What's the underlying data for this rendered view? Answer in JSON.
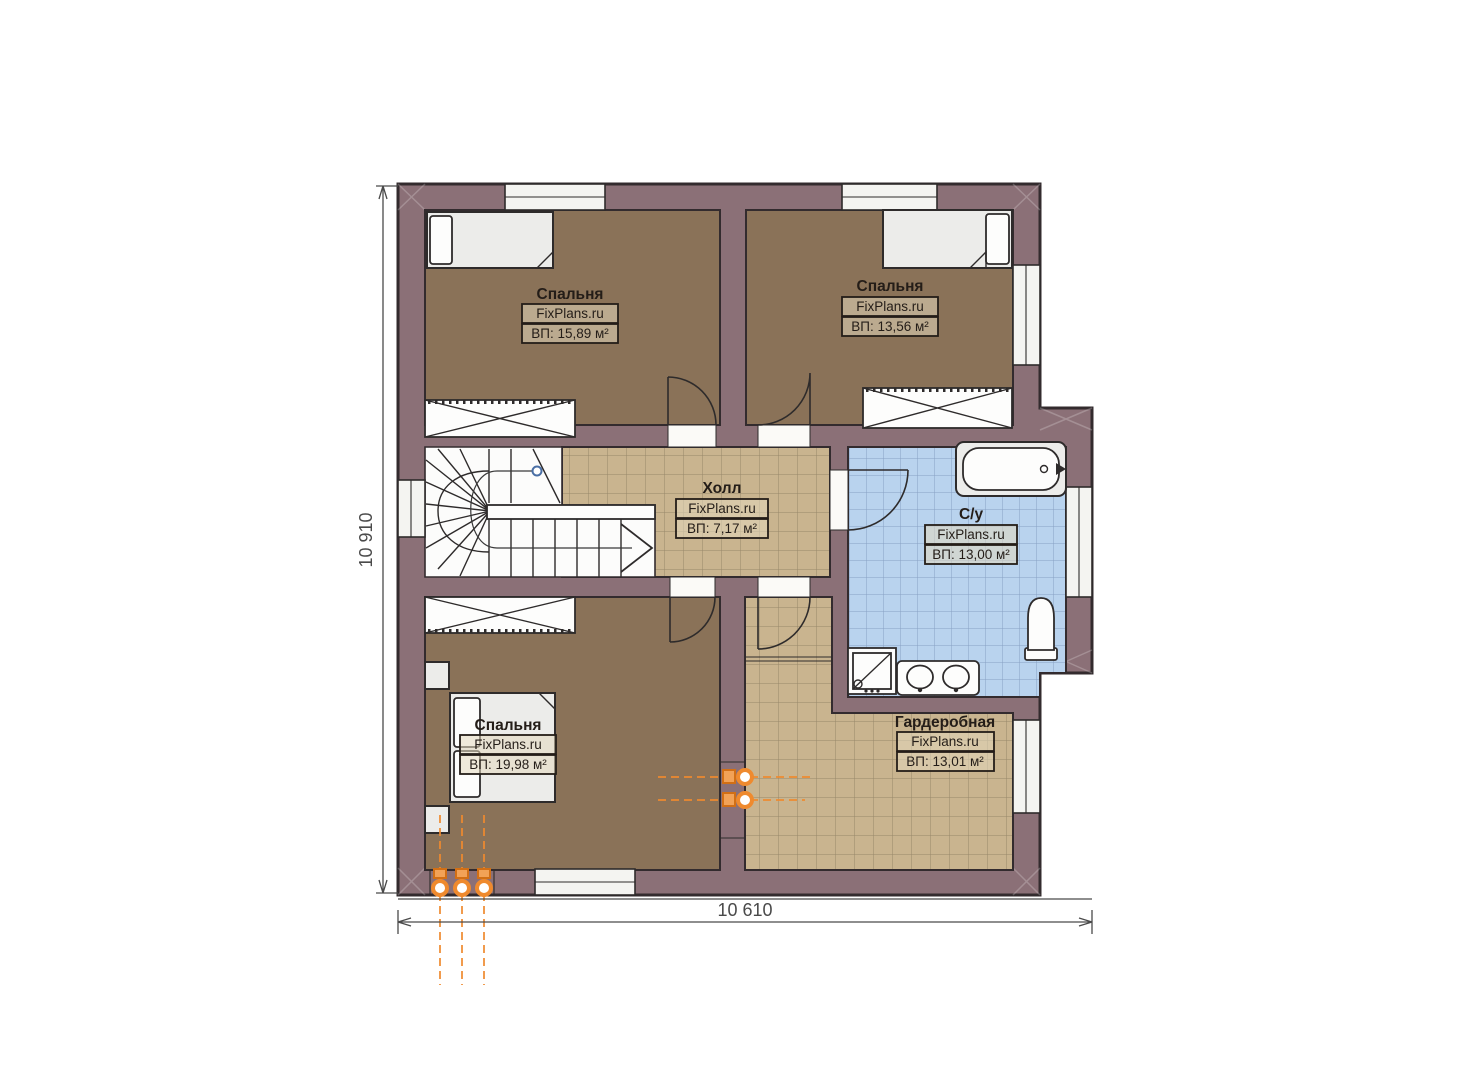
{
  "plan": {
    "rooms": [
      {
        "id": "bedroom-1",
        "name": "Спальня",
        "watermark": "FixPlans.ru",
        "area": "ВП: 15,89 м²"
      },
      {
        "id": "bedroom-2",
        "name": "Спальня",
        "watermark": "FixPlans.ru",
        "area": "ВП: 13,56 м²"
      },
      {
        "id": "hall",
        "name": "Холл",
        "watermark": "FixPlans.ru",
        "area": "ВП: 7,17 м²"
      },
      {
        "id": "bathroom",
        "name": "С/у",
        "watermark": "FixPlans.ru",
        "area": "ВП: 13,00 м²"
      },
      {
        "id": "bedroom-3",
        "name": "Спальня",
        "watermark": "FixPlans.ru",
        "area": "ВП: 19,98 м²"
      },
      {
        "id": "wardrobe",
        "name": "Гардеробная",
        "watermark": "FixPlans.ru",
        "area": "ВП: 13,01 м²"
      }
    ],
    "dimensions": {
      "height_mm": "10 910",
      "width_mm": "10 610"
    }
  },
  "colors": {
    "wall": "#8b7077",
    "outline": "#332b2e",
    "bedroom_floor": "#8a7258",
    "tile_floor": "#c9b48f",
    "tile_line": "#97876a",
    "bath_floor": "#b9d3ee",
    "bath_line": "#88a0c4",
    "furniture": "#ececea",
    "accent_orange": "#ef8a2e",
    "dim_color": "#4a4a4a",
    "node_blue": "#4a6fa5"
  }
}
